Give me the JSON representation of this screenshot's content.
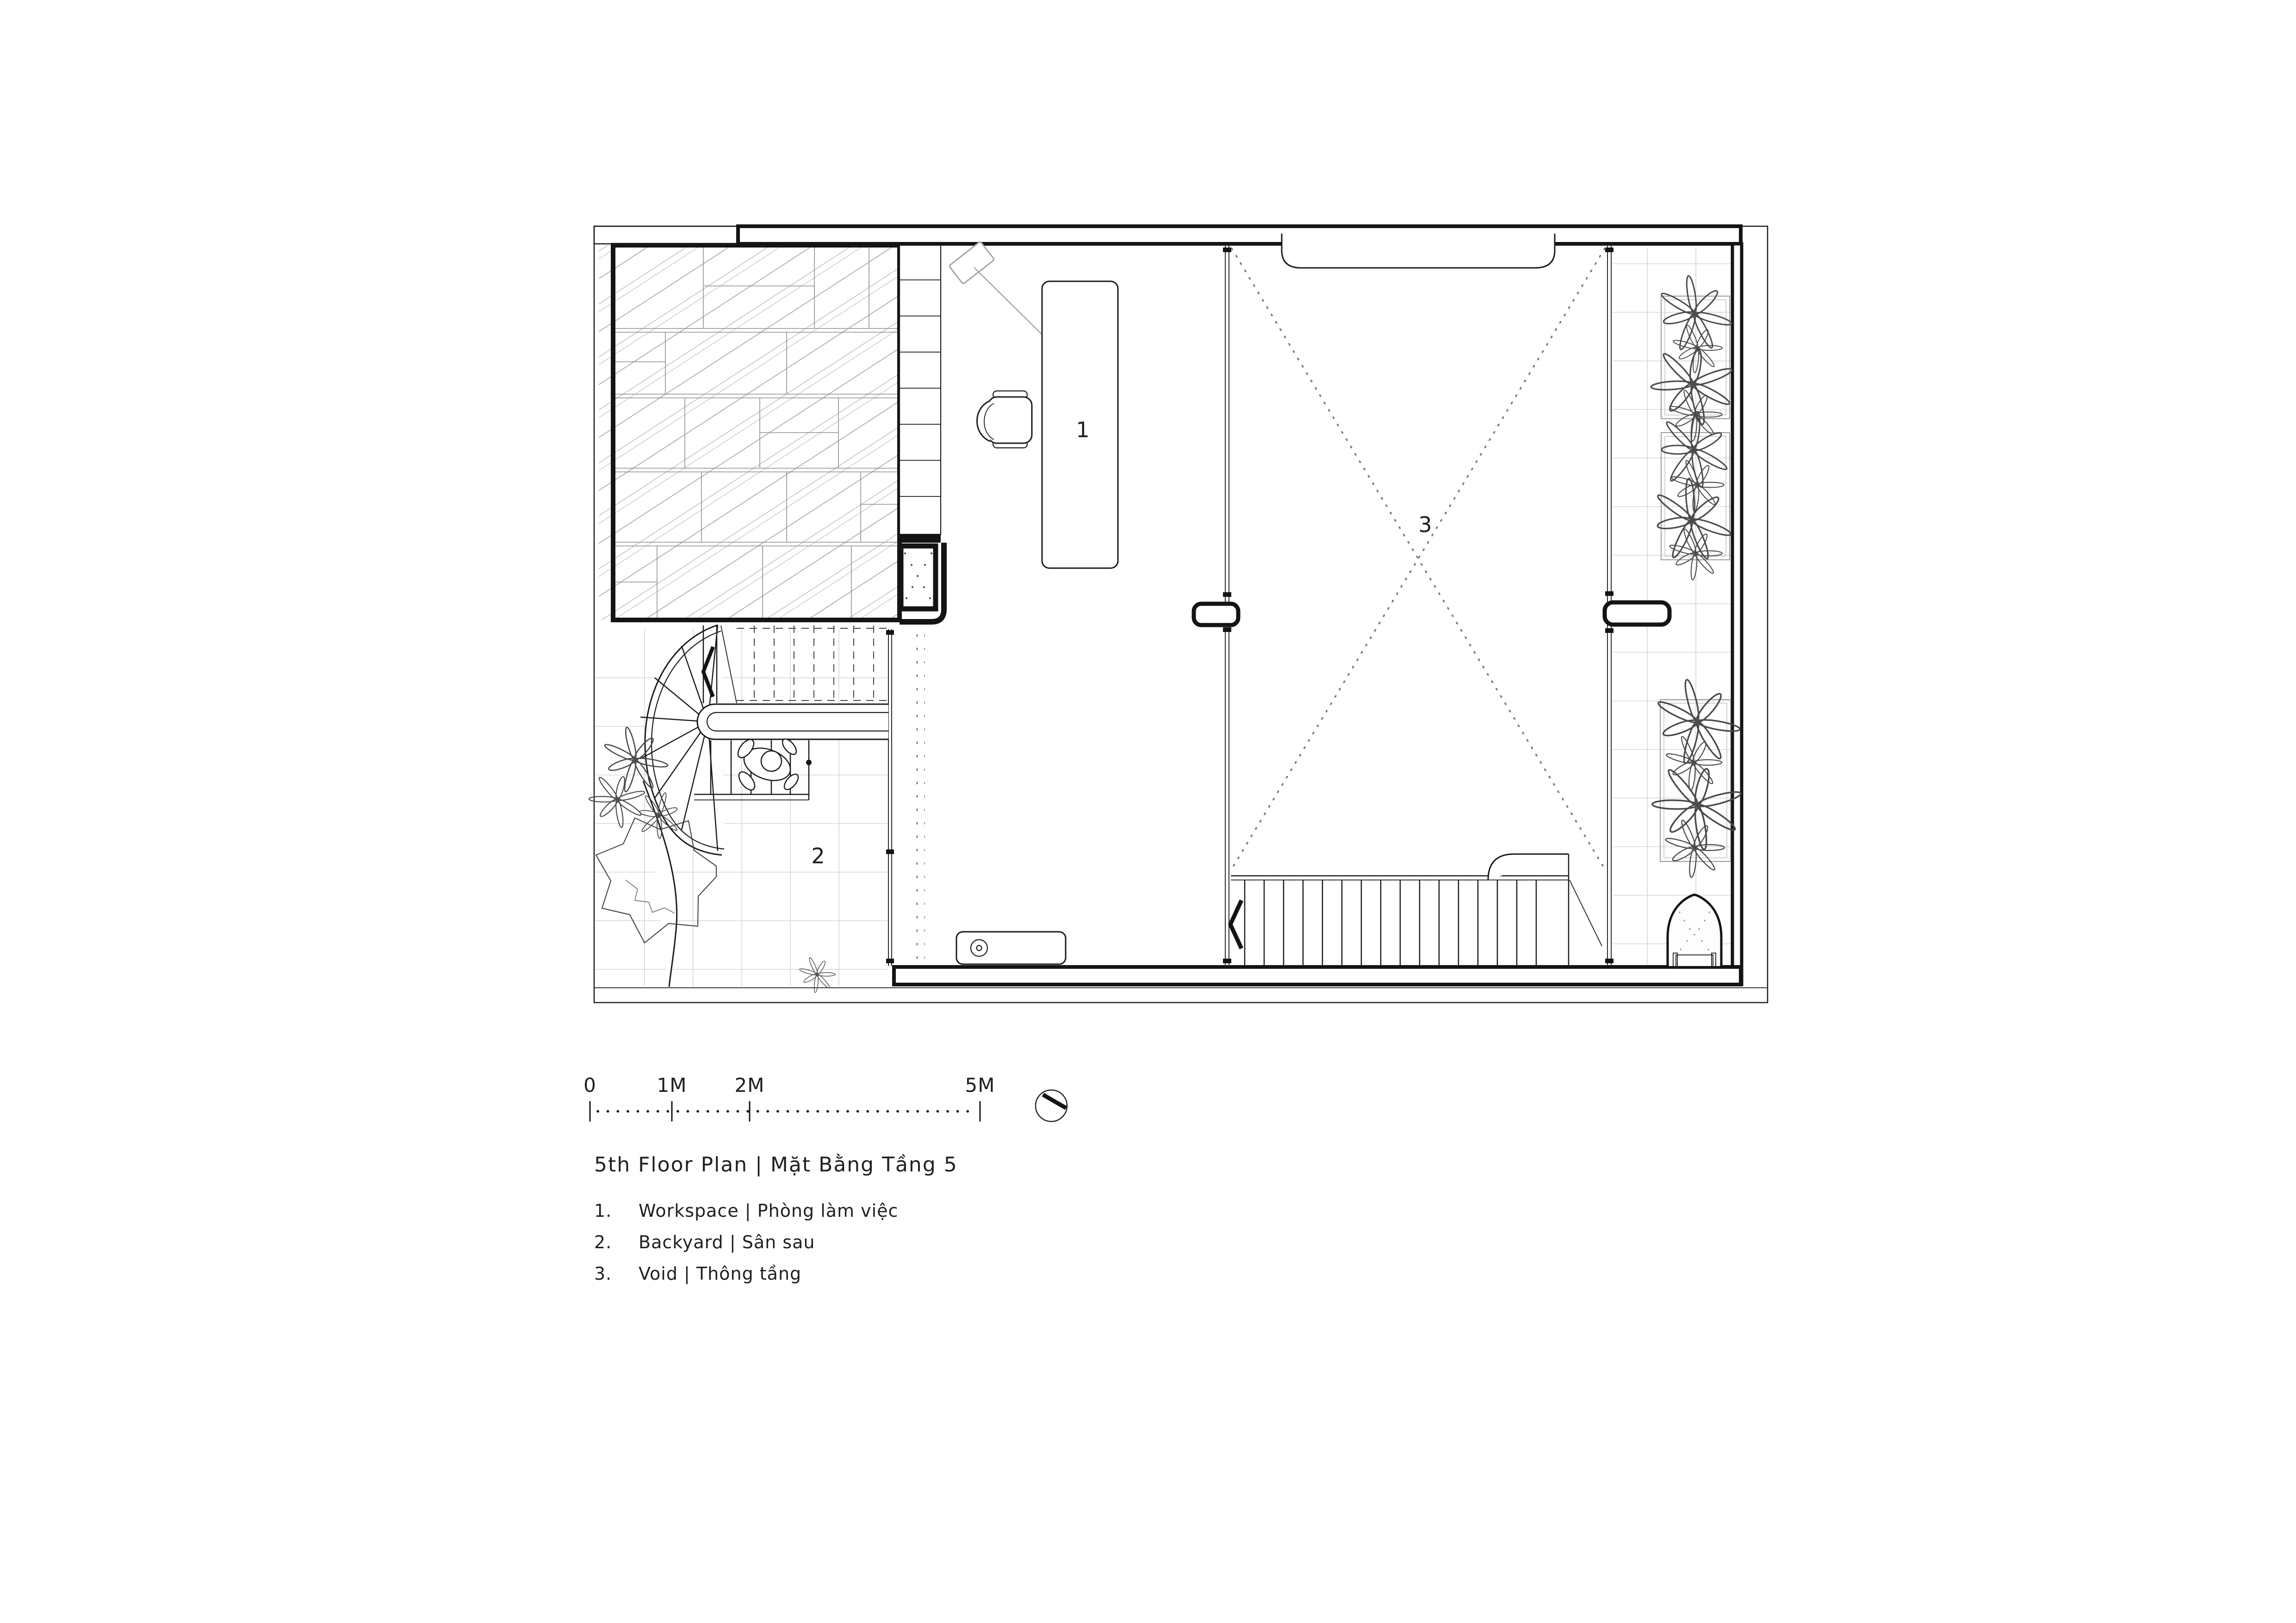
{
  "title": "5th Floor Plan | Mặt Bằng Tầng 5",
  "legend": {
    "items": [
      {
        "num": "1.",
        "label": "Workspace | Phòng làm việc"
      },
      {
        "num": "2.",
        "label": "Backyard | Sân sau"
      },
      {
        "num": "3.",
        "label": "Void | Thông tầng"
      }
    ]
  },
  "rooms": {
    "workspace": "1",
    "backyard": "2",
    "void": "3"
  },
  "scale_bar": {
    "labels": [
      "0",
      "1M",
      "2M",
      "5M"
    ]
  },
  "colors": {
    "ink": "#141414",
    "glass_hatch": "#b9b9b9",
    "tile_grid": "#d6d6d6",
    "background": "#ffffff"
  }
}
